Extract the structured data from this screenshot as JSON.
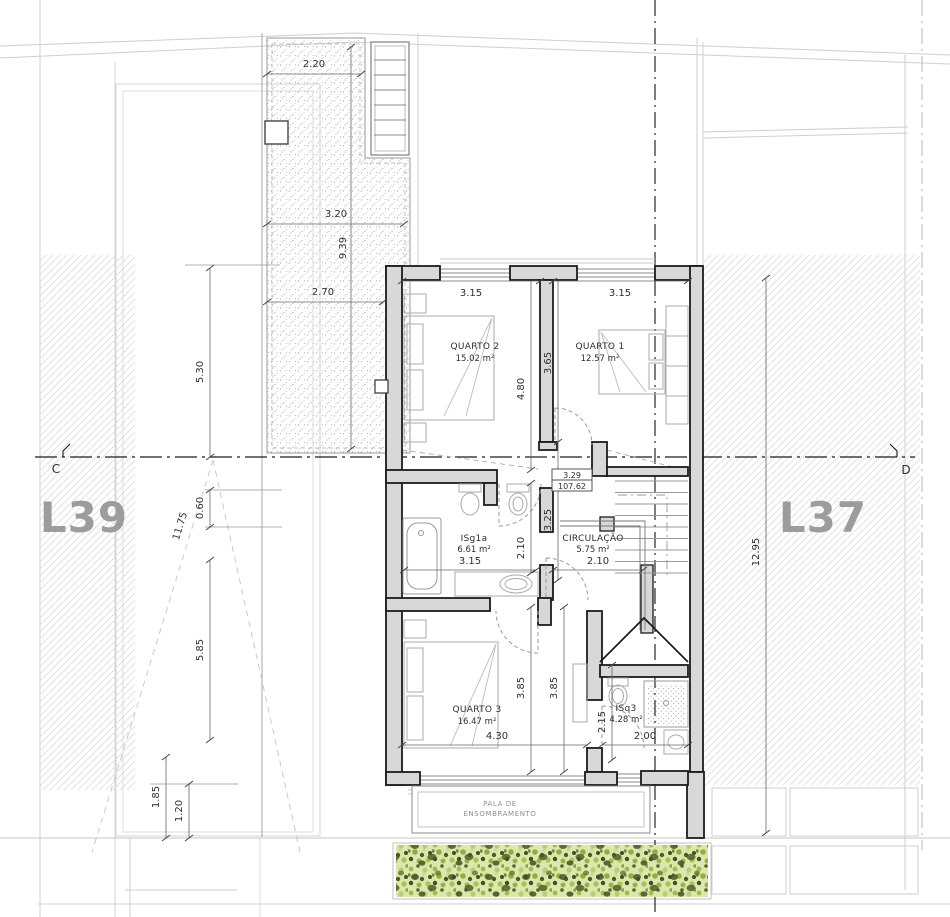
{
  "drawing": {
    "lots": {
      "left_label": "L39",
      "right_label": "L37"
    },
    "section_markers": {
      "left": "C",
      "right": "D"
    },
    "rooms": {
      "quarto2": {
        "name": "QUARTO 2",
        "area": "15.02 m²"
      },
      "quarto1": {
        "name": "QUARTO 1",
        "area": "12.57 m²"
      },
      "isg1a": {
        "name": "ISg1a",
        "area": "6.61 m²"
      },
      "circulacao": {
        "name": "CIRCULAÇÃO",
        "area": "5.75 m²"
      },
      "quarto3": {
        "name": "QUARTO 3",
        "area": "16.47 m²"
      },
      "isq3": {
        "name": "ISq3",
        "area": "4.28 m²"
      }
    },
    "levels": {
      "mid": {
        "height": "3.29",
        "elevation": "107.62"
      },
      "bottom": {
        "height": "3.27",
        "elevation": "107.60"
      }
    },
    "canopy": {
      "line1": "PALA DE",
      "line2": "ENSOMBRAMENTO"
    },
    "dimensions": {
      "terrace_width_top": "2.20",
      "terrace_width_mid": "3.20",
      "terrace_depth": "9.39",
      "terrace_width_low": "2.70",
      "site_left_upper": "5.30",
      "site_left_step": "0.60",
      "site_left_diagonal": "11.75",
      "site_left_lower": "5.85",
      "site_left_bottom_a": "1.85",
      "site_left_bottom_b": "1.20",
      "site_right_depth": "12.95",
      "quarto2_width": "3.15",
      "quarto1_width": "3.15",
      "quarto2_depth": "4.80",
      "quarto1_depth": "3.65",
      "circulacao_depth": "3.25",
      "isg1a_depth": "2.10",
      "isg1a_width": "3.15",
      "circulacao_width": "2.10",
      "quarto3_depth_left": "3.85",
      "quarto3_depth_right": "3.85",
      "quarto3_width": "4.30",
      "isq3_depth": "2.15",
      "isq3_width": "2.00"
    },
    "colors": {
      "wall_fill": "#d8d8d8",
      "wall_stroke": "#1b1b1b",
      "hatch_line": "#dedede",
      "hedge_light": "#b9cf6d",
      "hedge_dark": "#42521c",
      "label_gray": "#9c9c9c"
    }
  }
}
